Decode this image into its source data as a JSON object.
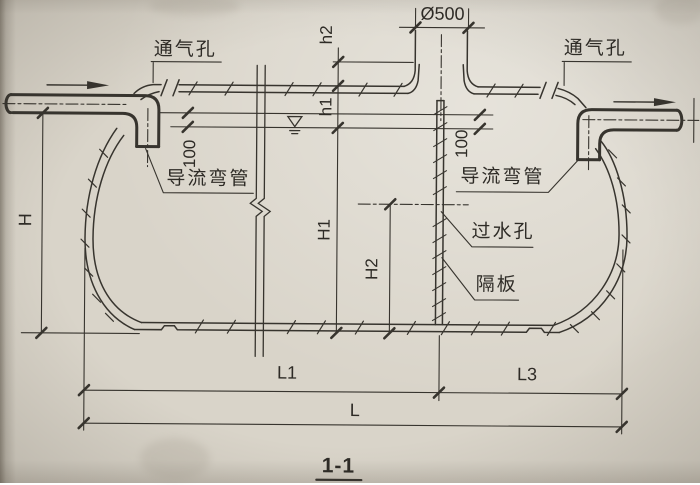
{
  "title": {
    "section": "1-1"
  },
  "labels": {
    "vent_left": "通气孔",
    "vent_right": "通气孔",
    "manhole_diameter": "Ø500",
    "h2": "h2",
    "h1": "h1",
    "inlet_drop": "100",
    "outlet_drop": "100",
    "guide_elbow_left": "导流弯管",
    "guide_elbow_right": "导流弯管",
    "water_pass_hole": "过水孔",
    "baffle": "隔板",
    "overall_height": "H",
    "water_depth": "H1",
    "hole_height": "H2",
    "chamber1_length": "L1",
    "chamber3_length": "L3",
    "total_length": "L"
  },
  "symbols": {
    "water_level": "water-level-triangle",
    "flow_in": "arrow-right",
    "flow_out": "arrow-right"
  },
  "colors": {
    "line": "#37342e",
    "paper": "#d9d4c9",
    "text": "#2e2b26"
  }
}
